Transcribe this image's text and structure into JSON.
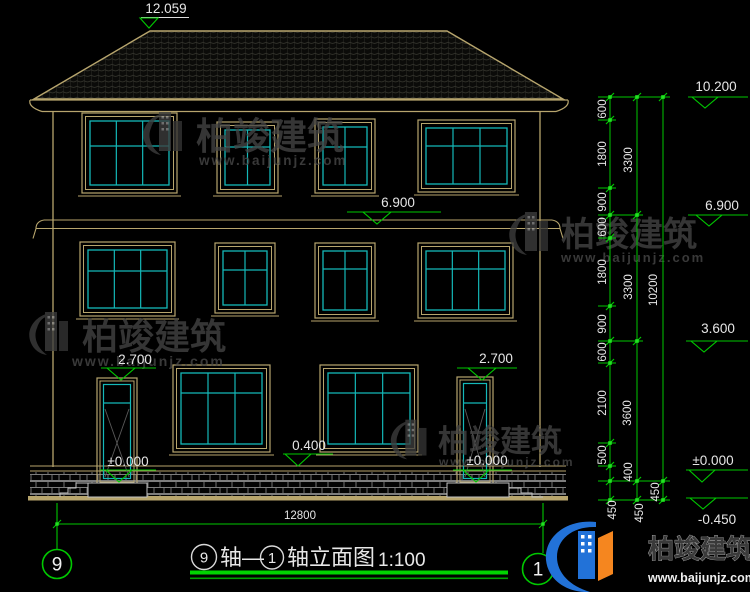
{
  "levels": {
    "ridge": "12.059",
    "parapet_right": "10.200",
    "floor3_mid": "6.900",
    "floor3_right": "6.900",
    "floor2_right": "3.600",
    "door_top_left": "2.700",
    "door_top_right": "2.700",
    "ground_zero_left": "±0.000",
    "ground_zero_mid": "±0.000",
    "ground_zero_right": "±0.000",
    "terrace": "0.400",
    "site_grade": "-0.450"
  },
  "dimensions": {
    "chain_inner": [
      "600",
      "1800",
      "900",
      "600",
      "1800",
      "900",
      "600",
      "2100",
      "500",
      "400",
      "450"
    ],
    "chain_middle": [
      "3300",
      "3300",
      "3600",
      "450"
    ],
    "chain_outer": [
      "10200",
      "450"
    ],
    "overall_width": "12800"
  },
  "axis_bubbles": {
    "left": "9",
    "right": "1"
  },
  "title": {
    "bubble_start": "9",
    "between": "轴—",
    "bubble_end": "1",
    "label": "轴立面图",
    "scale": "1:100"
  },
  "watermark": {
    "name": "柏竣建筑",
    "url": "www.baijunjz.com"
  },
  "brand": {
    "name": "柏竣建筑",
    "url": "www.baijunjz.com"
  }
}
